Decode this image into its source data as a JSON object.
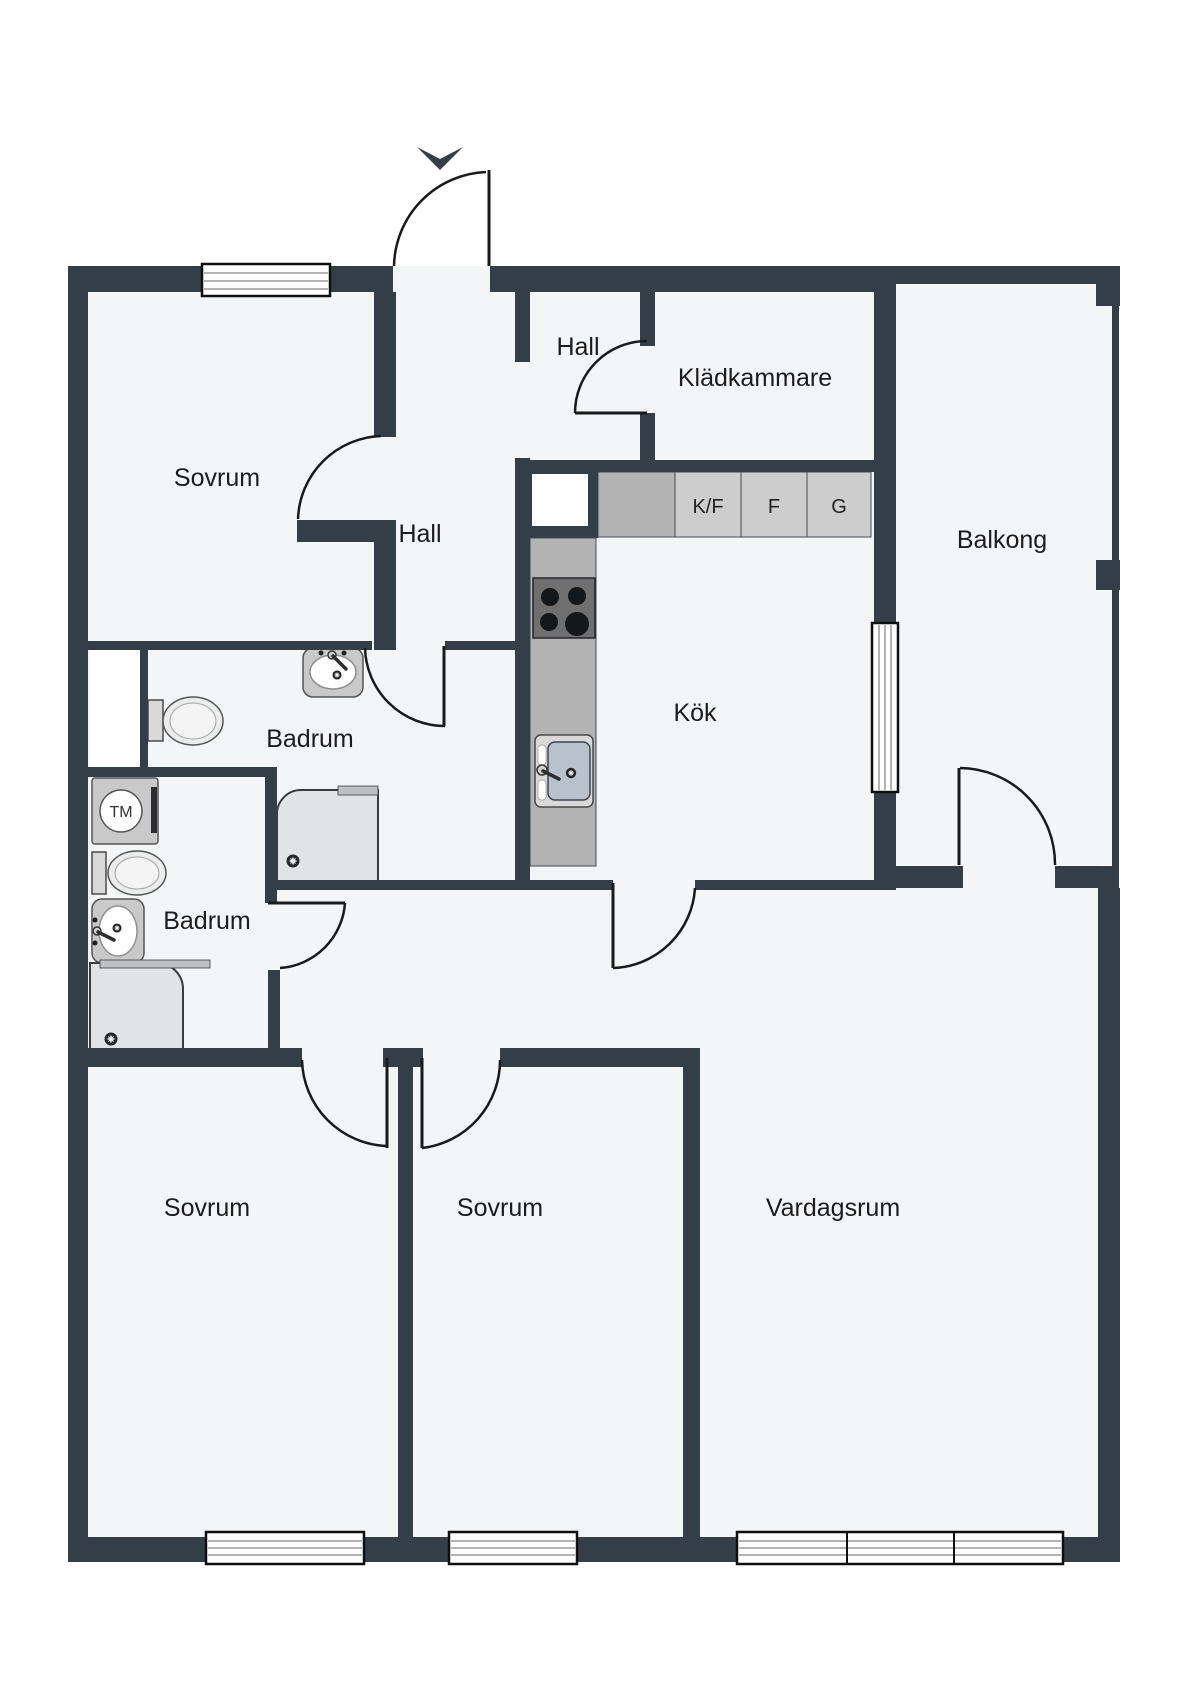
{
  "rooms": {
    "sovrum_nw": "Sovrum",
    "hall_upper": "Hall",
    "kladkammare": "Klädkammare",
    "hall": "Hall",
    "kok": "Kök",
    "balkong": "Balkong",
    "badrum_upper": "Badrum",
    "badrum_lower": "Badrum",
    "sovrum_sw": "Sovrum",
    "sovrum_s": "Sovrum",
    "vardagsrum": "Vardagsrum"
  },
  "appliances": {
    "fridge_freezer": "K/F",
    "freezer": "F",
    "g_unit": "G",
    "washing_machine": "TM"
  },
  "colors": {
    "wall": "#333e49",
    "floor": "#f4f5f7",
    "counter": "#b3b3b3",
    "appliance_block": "#cdcdcd",
    "stove": "#6f6f6f",
    "fixture": "#c9c9c9"
  }
}
